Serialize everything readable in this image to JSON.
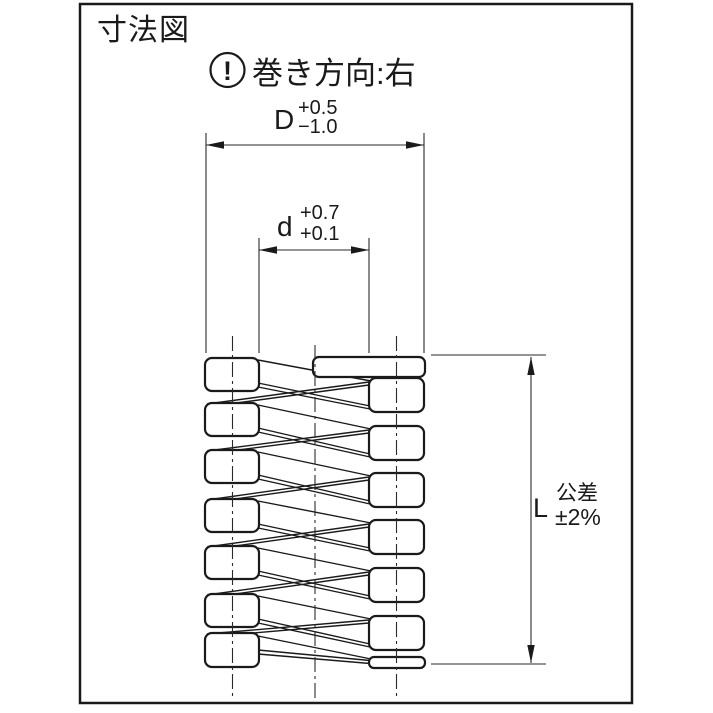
{
  "title": "寸法図",
  "note": {
    "symbol": "!",
    "text": "巻き方向:右"
  },
  "dim_D": {
    "letter": "D",
    "tol_upper": "+0.5",
    "tol_lower": "−1.0"
  },
  "dim_d": {
    "letter": "d",
    "tol_upper": "+0.7",
    "tol_lower": "+0.1"
  },
  "dim_L": {
    "letter": "L",
    "tol_title": "公差",
    "tol_value": "±2%"
  },
  "colors": {
    "line": "#1a1a1a",
    "background": "#ffffff"
  }
}
